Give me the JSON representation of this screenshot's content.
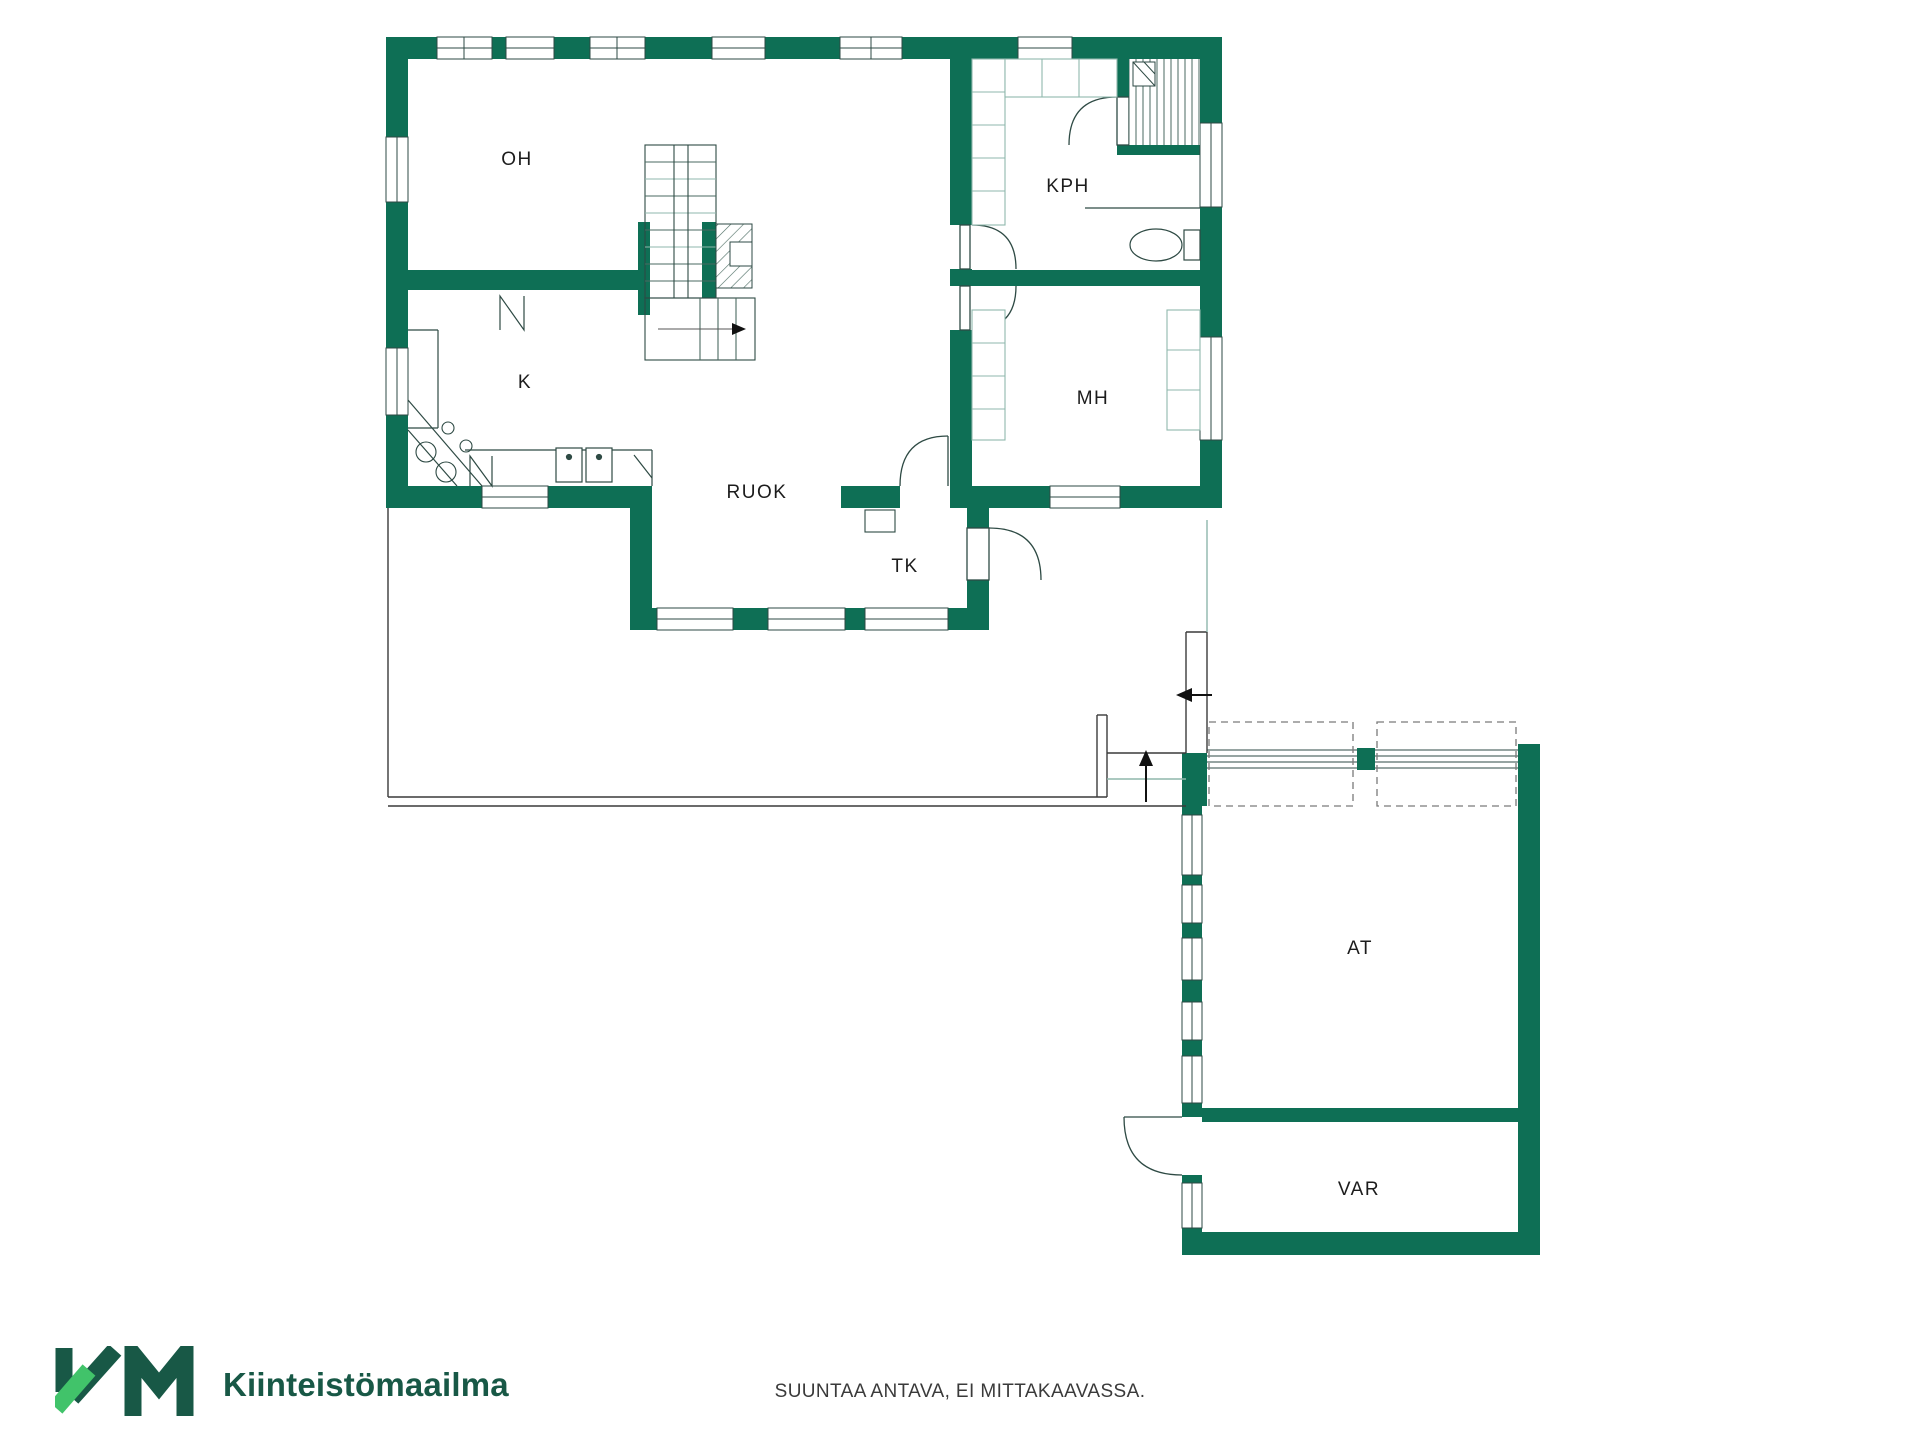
{
  "plan": {
    "rooms": [
      {
        "id": "oh",
        "label": "OH"
      },
      {
        "id": "kph",
        "label": "KPH"
      },
      {
        "id": "k",
        "label": "K"
      },
      {
        "id": "mh",
        "label": "MH"
      },
      {
        "id": "ruok",
        "label": "RUOK"
      },
      {
        "id": "tk",
        "label": "TK"
      },
      {
        "id": "at",
        "label": "AT"
      },
      {
        "id": "var",
        "label": "VAR"
      }
    ],
    "colors": {
      "wall_green": "#0E6F55",
      "line_dark": "#2E4A44",
      "line_light": "#8FB7AC",
      "dashed_gray": "#7a7a7a",
      "arrow_black": "#111111"
    }
  },
  "footer": {
    "brand": "Kiinteistömaailma",
    "disclaimer": "SUUNTAA ANTAVA, EI MITTAKAAVASSA.",
    "logo_dark_green": "#185846",
    "logo_light_green": "#41C36A"
  }
}
